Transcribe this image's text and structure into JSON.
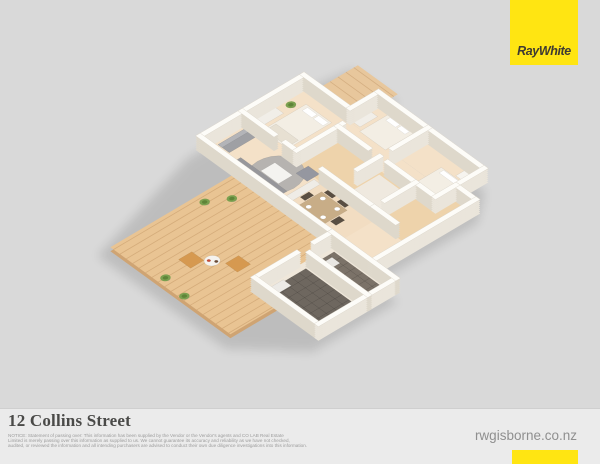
{
  "page": {
    "bg": "#d9d9d9",
    "footer_bg": "#ebebeb"
  },
  "brand": {
    "name": "RayWhite",
    "yellow": "#ffe512",
    "text_color": "#3e3a33"
  },
  "footer": {
    "title": "12 Collins Street",
    "disclaimer_lines": [
      "NOTICE: Statement of passing over: This information has been supplied by the Vendor or the Vendor's agents and CO LAB Real Estate",
      "Limited is merely passing over this information as supplied to us. We cannot guarantee its accuracy and reliability as we have not checked,",
      "audited, or reviewed the information and all intending purchasers are advised to conduct their own due diligence investigations into this information."
    ],
    "website": "rwgisborne.co.nz"
  },
  "floorplan": {
    "palette": {
      "wall_top": "#fdfcf8",
      "wall_side_u": "#eae5db",
      "wall_side_v": "#ded8cb",
      "floor": "#f4e1c8",
      "wood": "#e9c493",
      "path_wood": "#e8c79c",
      "hall_wood": "#eed3ab",
      "tile_dark": "#6e675f",
      "shadow": "#000000"
    },
    "shadow_hull": [
      [
        -4,
        -4
      ],
      [
        122,
        -4
      ],
      [
        176,
        4
      ],
      [
        176,
        62
      ],
      [
        154,
        62
      ],
      [
        154,
        194
      ],
      [
        122,
        220
      ],
      [
        4,
        220
      ],
      [
        4,
        250
      ],
      [
        -92,
        250
      ],
      [
        -144,
        198
      ],
      [
        -144,
        38
      ]
    ],
    "areas": [
      {
        "name": "deck",
        "rect": [
          -140,
          42,
          4,
          192
        ],
        "color": "#e9c493",
        "edge": "#cfa473",
        "plank": {
          "dir": "u",
          "step": 8
        }
      },
      {
        "name": "entry-path",
        "rect": [
          118,
          8,
          172,
          58
        ],
        "color": "#e8c79c",
        "plank": {
          "dir": "v",
          "step": 9
        }
      },
      {
        "name": "floor-main",
        "rect": [
          0,
          0,
          118,
          215
        ],
        "color": "#f4e1c8"
      },
      {
        "name": "floor-annex",
        "rect": [
          118,
          58,
          150,
          190
        ],
        "color": "#f4e1c8"
      },
      {
        "name": "floor-utility-block",
        "rect": [
          -88,
          165,
          0,
          245
        ],
        "color": "#efe7da"
      },
      {
        "name": "floor-hallway",
        "rect": [
          48,
          68,
          95,
          215
        ],
        "color": "#eed3ab"
      },
      {
        "name": "floor-hallway-2",
        "rect": [
          95,
          190,
          118,
          215
        ],
        "color": "#eed3ab"
      },
      {
        "name": "floor-dining",
        "rect": [
          0,
          100,
          48,
          165
        ],
        "color": "#f2ddc2"
      },
      {
        "name": "floor-bathroom",
        "rect": [
          52,
          124,
          91,
          161
        ],
        "color": "#efe9df"
      },
      {
        "name": "tile-garage-a",
        "rect": [
          -80,
          172,
          -36,
          241
        ],
        "color": "#6e675f",
        "grid": 9
      },
      {
        "name": "tile-garage-b",
        "rect": [
          -28,
          172,
          -4,
          241
        ],
        "color": "#7b7268",
        "grid": 9
      }
    ],
    "walls": [
      [
        0,
        0,
        118,
        0
      ],
      [
        0,
        0,
        0,
        165
      ],
      [
        118,
        0,
        118,
        58
      ],
      [
        118,
        58,
        150,
        58
      ],
      [
        150,
        58,
        150,
        190
      ],
      [
        118,
        190,
        150,
        190
      ],
      [
        118,
        190,
        118,
        215
      ],
      [
        0,
        215,
        118,
        215
      ],
      [
        -88,
        165,
        -40,
        165
      ],
      [
        -20,
        165,
        0,
        165
      ],
      [
        -88,
        165,
        -88,
        245
      ],
      [
        -88,
        245,
        0,
        245
      ],
      [
        0,
        165,
        0,
        245
      ],
      [
        48,
        0,
        48,
        40
      ],
      [
        48,
        54,
        48,
        68
      ],
      [
        48,
        68,
        100,
        68
      ],
      [
        95,
        68,
        95,
        106
      ],
      [
        110,
        120,
        150,
        120
      ],
      [
        95,
        130,
        95,
        190
      ],
      [
        95,
        190,
        118,
        190
      ],
      [
        48,
        100,
        48,
        165
      ],
      [
        70,
        120,
        95,
        120
      ],
      [
        60,
        165,
        95,
        165
      ],
      [
        48,
        165,
        48,
        192
      ],
      [
        -32,
        172,
        -32,
        245
      ]
    ],
    "furniture": [
      {
        "name": "area-rug",
        "shape": "ellipse",
        "c": [
          26,
          66
        ],
        "r": [
          26,
          23
        ],
        "color": "#b6b3b0"
      },
      {
        "name": "sofa",
        "shape": "rect",
        "rect": [
          4,
          30,
          19,
          88
        ],
        "color": "#97979b"
      },
      {
        "name": "sofa-back",
        "shape": "rect",
        "rect": [
          4,
          30,
          9,
          88
        ],
        "color": "#acacb0"
      },
      {
        "name": "sofa-top",
        "shape": "rect",
        "rect": [
          16,
          5,
          50,
          19
        ],
        "color": "#9fa0a4"
      },
      {
        "name": "sofa-top-back",
        "shape": "rect",
        "rect": [
          16,
          5,
          50,
          10
        ],
        "color": "#b3b4b8"
      },
      {
        "name": "coffee-table",
        "shape": "rect",
        "rect": [
          20,
          54,
          36,
          76
        ],
        "color": "#f4f3f0"
      },
      {
        "name": "armchair",
        "shape": "rect",
        "rect": [
          40,
          76,
          54,
          90
        ],
        "color": "#9597a0"
      },
      {
        "name": "tv-unit",
        "shape": "rect",
        "rect": [
          10,
          92,
          46,
          100
        ],
        "color": "#efece6"
      },
      {
        "name": "dining-table",
        "shape": "rect",
        "rect": [
          14,
          108,
          40,
          140
        ],
        "color": "#c8ad87"
      },
      {
        "name": "dining-chair",
        "shape": "rect",
        "rect": [
          6,
          110,
          13,
          120
        ],
        "color": "#594e42"
      },
      {
        "name": "dining-chair",
        "shape": "rect",
        "rect": [
          6,
          126,
          13,
          136
        ],
        "color": "#594e42"
      },
      {
        "name": "dining-chair",
        "shape": "rect",
        "rect": [
          41,
          110,
          48,
          120
        ],
        "color": "#594e42"
      },
      {
        "name": "dining-chair",
        "shape": "rect",
        "rect": [
          41,
          126,
          48,
          136
        ],
        "color": "#594e42"
      },
      {
        "name": "dining-chair",
        "shape": "rect",
        "rect": [
          22,
          101,
          32,
          107
        ],
        "color": "#594e42"
      },
      {
        "name": "dining-chair",
        "shape": "rect",
        "rect": [
          20,
          141,
          30,
          148
        ],
        "color": "#594e42"
      },
      {
        "name": "plate",
        "shape": "ellipse",
        "c": [
          19,
          115
        ],
        "r": [
          2.4,
          2.4
        ],
        "color": "#ffffff"
      },
      {
        "name": "plate",
        "shape": "ellipse",
        "c": [
          35,
          115
        ],
        "r": [
          2.4,
          2.4
        ],
        "color": "#ffffff"
      },
      {
        "name": "plate",
        "shape": "ellipse",
        "c": [
          19,
          133
        ],
        "r": [
          2.4,
          2.4
        ],
        "color": "#ffffff"
      },
      {
        "name": "plate",
        "shape": "ellipse",
        "c": [
          35,
          133
        ],
        "r": [
          2.4,
          2.4
        ],
        "color": "#ffffff"
      },
      {
        "name": "kitchen-counter",
        "shape": "rect",
        "rect": [
          1,
          110,
          14,
          163
        ],
        "color": "#f6f5f2"
      },
      {
        "name": "cooktop",
        "shape": "rect",
        "rect": [
          3,
          126,
          12,
          146
        ],
        "color": "#3b3b3b"
      },
      {
        "name": "kitchen-sink",
        "shape": "rect",
        "rect": [
          4,
          152,
          11,
          160
        ],
        "color": "#e4e4e2"
      },
      {
        "name": "bed-1",
        "shape": "rect",
        "rect": [
          56,
          16,
          106,
          48
        ],
        "color": "#f3eee4"
      },
      {
        "name": "bed-1-pillow",
        "shape": "rect",
        "rect": [
          98,
          20,
          104,
          32
        ],
        "color": "#ffffff"
      },
      {
        "name": "bed-1-pillow",
        "shape": "rect",
        "rect": [
          98,
          34,
          104,
          46
        ],
        "color": "#ffffff"
      },
      {
        "name": "bed-1-throw",
        "shape": "rect",
        "rect": [
          58,
          18,
          70,
          46
        ],
        "color": "#e7e0d2"
      },
      {
        "name": "dresser-1",
        "shape": "rect",
        "rect": [
          62,
          2,
          84,
          12
        ],
        "color": "#f1eee8"
      },
      {
        "name": "bed-2",
        "shape": "rect",
        "rect": [
          116,
          72,
          148,
          104
        ],
        "color": "#f3eee4"
      },
      {
        "name": "bed-2-pillow",
        "shape": "rect",
        "rect": [
          142,
          76,
          147,
          88
        ],
        "color": "#ffffff"
      },
      {
        "name": "bed-2-pillow",
        "shape": "rect",
        "rect": [
          142,
          90,
          147,
          100
        ],
        "color": "#ffffff"
      },
      {
        "name": "dresser-2",
        "shape": "rect",
        "rect": [
          120,
          60,
          140,
          68
        ],
        "color": "#f1eee8"
      },
      {
        "name": "bed-3",
        "shape": "rect",
        "rect": [
          98,
          152,
          136,
          186
        ],
        "color": "#f3eee4"
      },
      {
        "name": "bed-3-pillow",
        "shape": "rect",
        "rect": [
          130,
          156,
          135,
          182
        ],
        "color": "#ffffff"
      },
      {
        "name": "wardrobe",
        "shape": "rect",
        "rect": [
          138,
          168,
          148,
          186
        ],
        "color": "#f6f4ef"
      },
      {
        "name": "vanity",
        "shape": "rect",
        "rect": [
          52,
          126,
          62,
          156
        ],
        "color": "#f6f5f1"
      },
      {
        "name": "toilet",
        "shape": "rect",
        "rect": [
          80,
          150,
          90,
          160
        ],
        "color": "#ffffff"
      },
      {
        "name": "laundry-bench",
        "shape": "rect",
        "rect": [
          -84,
          170,
          -60,
          180
        ],
        "color": "#eceae6"
      },
      {
        "name": "storage-unit",
        "shape": "rect",
        "rect": [
          -26,
          176,
          -10,
          186
        ],
        "color": "#e8e6e2"
      },
      {
        "name": "outdoor-chair",
        "shape": "rect",
        "rect": [
          -108,
          92,
          -93,
          107
        ],
        "color": "#d69950"
      },
      {
        "name": "outdoor-chair",
        "shape": "rect",
        "rect": [
          -82,
          122,
          -67,
          137
        ],
        "color": "#d69950"
      },
      {
        "name": "outdoor-table",
        "shape": "ellipse",
        "c": [
          -88,
          112
        ],
        "r": [
          7,
          6.5
        ],
        "color": "#f5f3ef"
      },
      {
        "name": "table-setting",
        "shape": "ellipse",
        "c": [
          -90,
          110
        ],
        "r": [
          1.6,
          1.6
        ],
        "color": "#c74a35"
      },
      {
        "name": "table-setting",
        "shape": "ellipse",
        "c": [
          -86,
          115
        ],
        "r": [
          1.6,
          1.6
        ],
        "color": "#6b4a35"
      }
    ],
    "plants": [
      [
        -42,
        52
      ],
      [
        -22,
        64
      ],
      [
        -132,
        102
      ],
      [
        -136,
        130
      ],
      [
        96,
        8
      ],
      [
        4,
        8
      ],
      [
        124,
        14
      ]
    ]
  }
}
